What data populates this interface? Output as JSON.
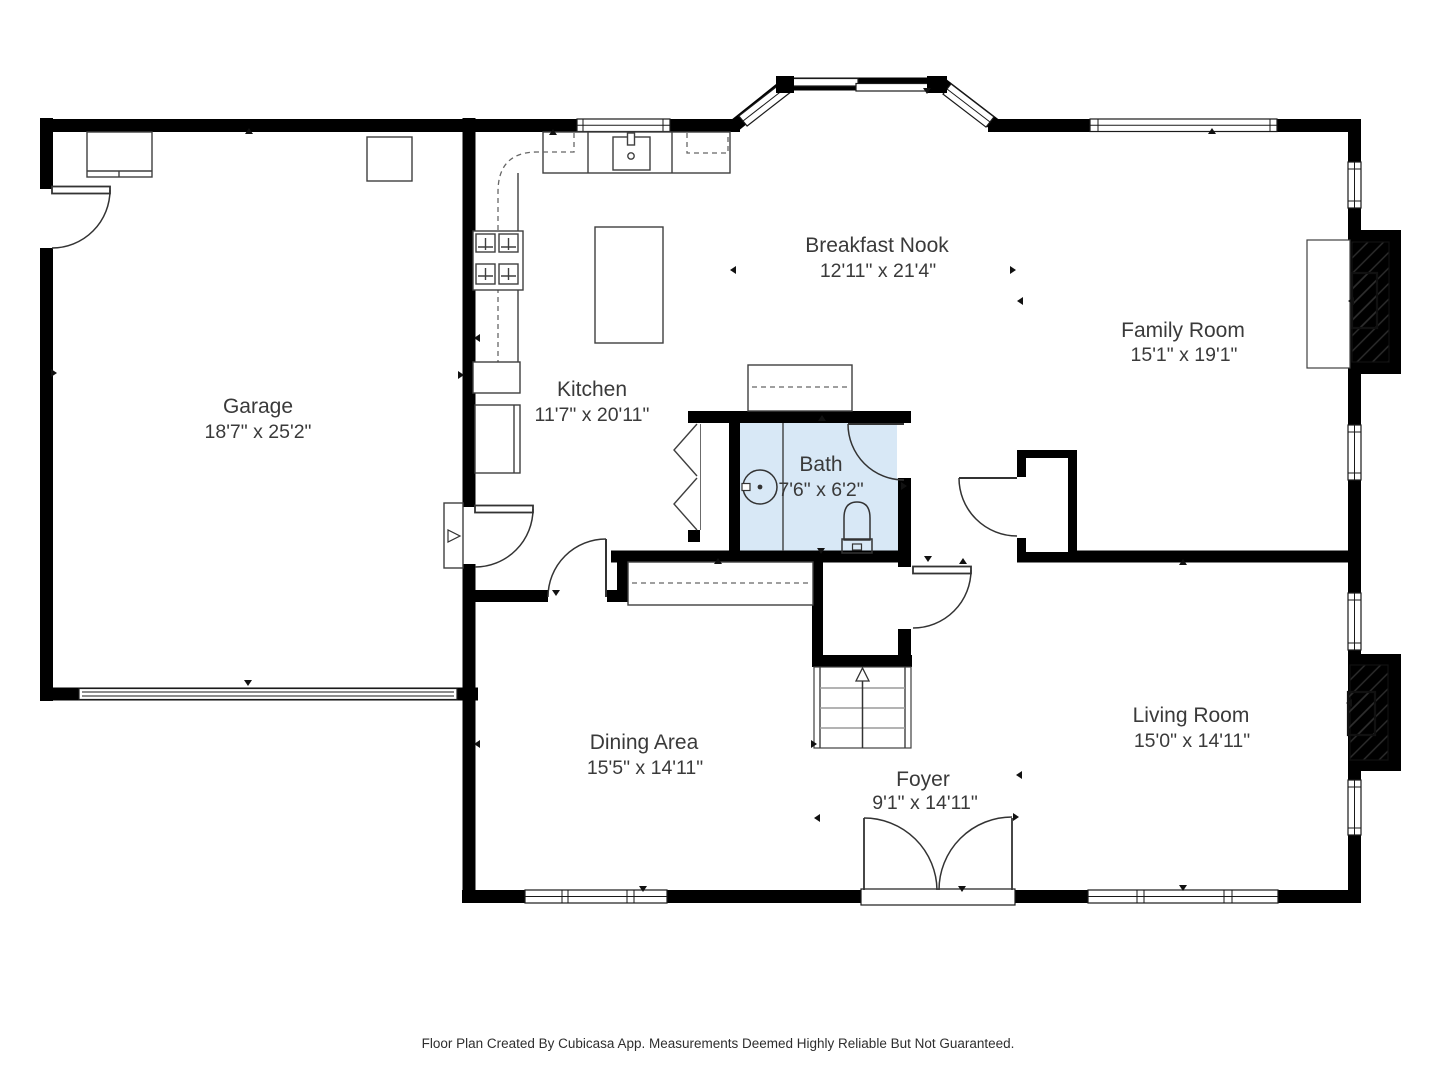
{
  "rooms": [
    {
      "key": "garage",
      "name": "Garage",
      "dims": "18'7\" x 25'2\""
    },
    {
      "key": "kitchen",
      "name": "Kitchen",
      "dims": "11'7\" x 20'11\""
    },
    {
      "key": "breakfast_nook",
      "name": "Breakfast Nook",
      "dims": "12'11\" x 21'4\""
    },
    {
      "key": "family_room",
      "name": "Family Room",
      "dims": "15'1\" x 19'1\""
    },
    {
      "key": "bath",
      "name": "Bath",
      "dims": "7'6\" x 6'2\""
    },
    {
      "key": "dining_area",
      "name": "Dining Area",
      "dims": "15'5\" x 14'11\""
    },
    {
      "key": "foyer",
      "name": "Foyer",
      "dims": "9'1\" x 14'11\""
    },
    {
      "key": "living_room",
      "name": "Living Room",
      "dims": "15'0\" x 14'11\""
    }
  ],
  "footer": {
    "disclaimer": "Floor Plan Created By Cubicasa App. Measurements Deemed Highly Reliable But Not Guaranteed."
  },
  "symbols": {
    "stairs_direction": "up-arrow",
    "door_swing": "quarter-arc",
    "wall_markers": "small-triangle-arrows",
    "fireplace_fill": "diagonal-hatch"
  },
  "colors": {
    "wall": "#000000",
    "bath_fill": "#d8e8f6",
    "label_text": "#3a3a3a",
    "fixture_line": "#3f3f3f"
  }
}
